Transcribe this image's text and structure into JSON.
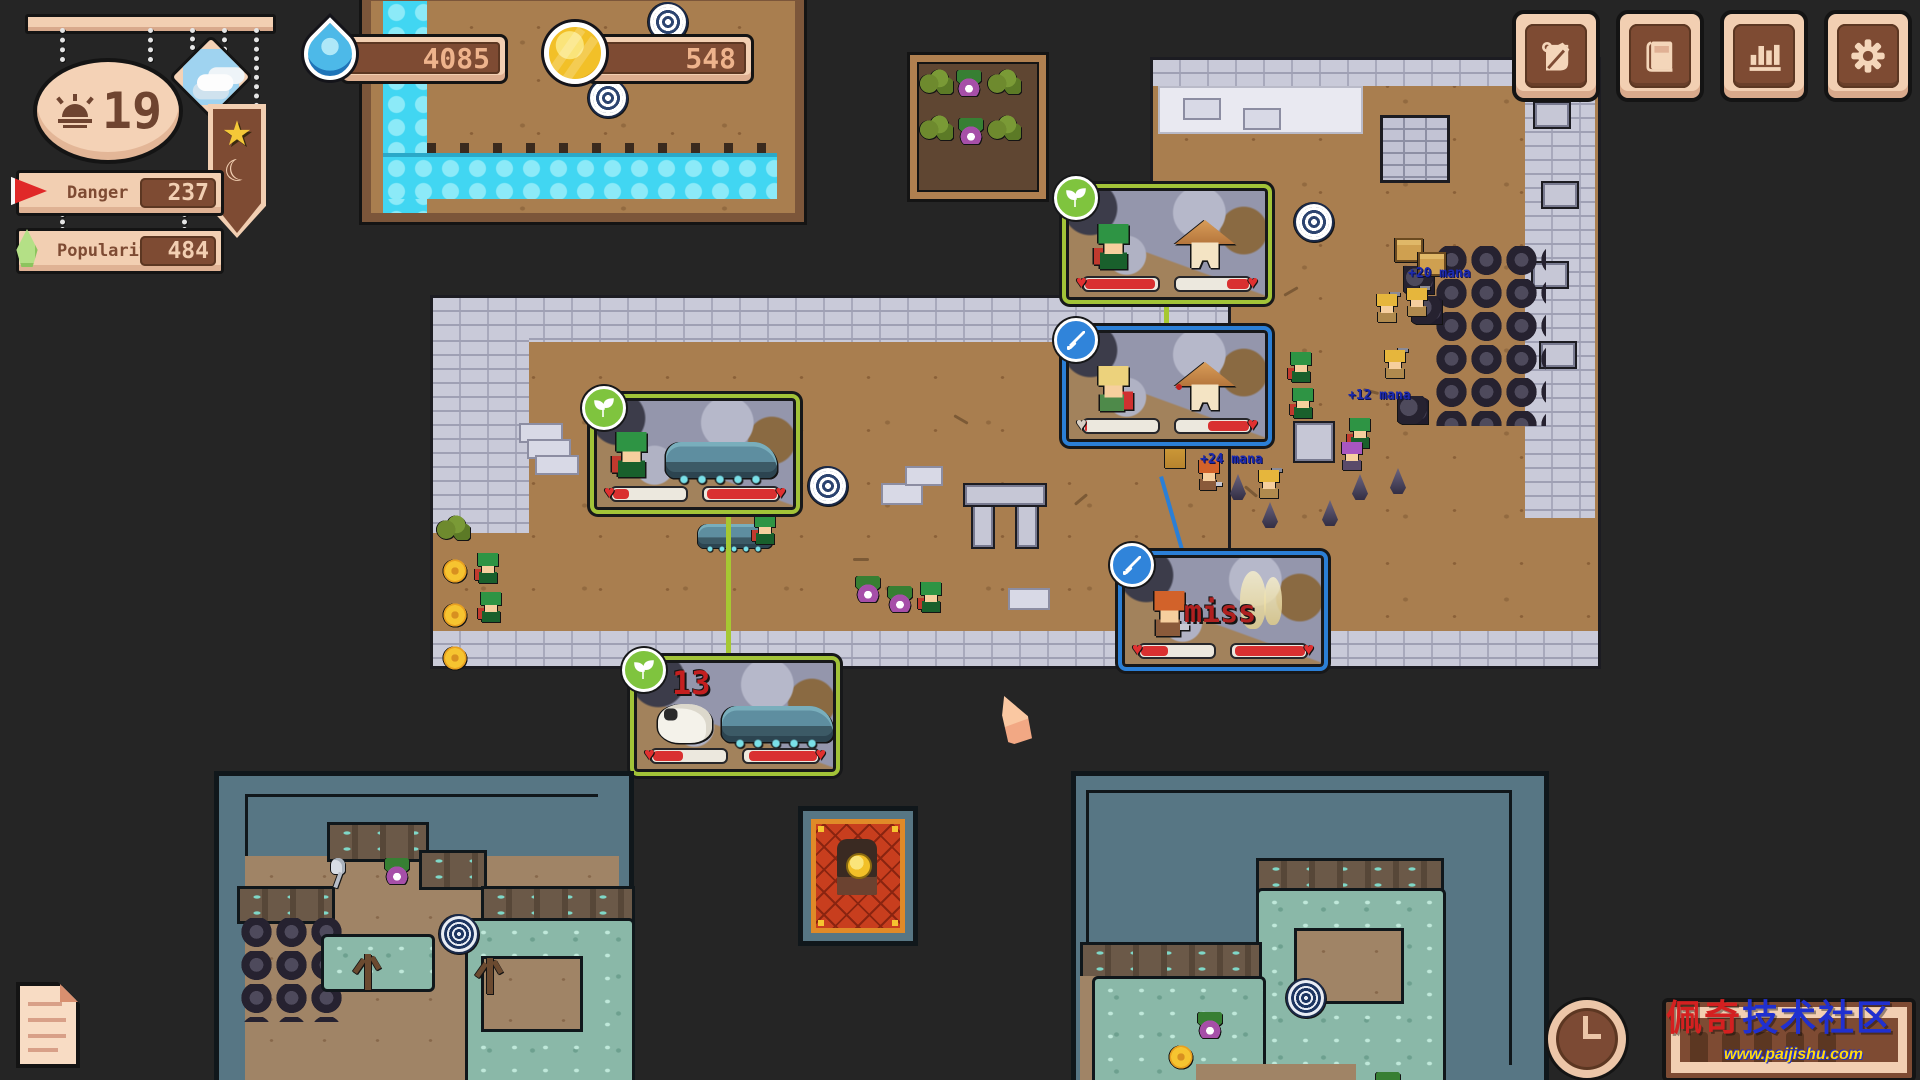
{
  "hud": {
    "day": "19",
    "day_icon": "sunrise",
    "weather_icon": "cloudy-sky",
    "banner_icons": [
      "gold-star",
      "crescent-moon"
    ],
    "danger": {
      "label": "Danger",
      "value": "237",
      "icon": "red-flag"
    },
    "popularity": {
      "label": "Popularity",
      "value": "484",
      "icon": "green-sprout"
    },
    "resources": {
      "water": {
        "value": "4085",
        "icon": "water-drop"
      },
      "gold": {
        "value": "548",
        "icon": "gold-coin"
      }
    }
  },
  "toolbar": {
    "buttons": [
      {
        "icon": "scroll-quill"
      },
      {
        "icon": "book"
      },
      {
        "icon": "bar-chart"
      },
      {
        "icon": "gear"
      }
    ]
  },
  "battles": [
    {
      "badge": "nature",
      "left_hp": 100,
      "right_hp": 30
    },
    {
      "badge": "combat",
      "left_hp": 3,
      "right_hp": 55
    },
    {
      "badge": "nature",
      "left_hp": 22,
      "right_hp": 100
    },
    {
      "badge": "nature",
      "left_hp": 40,
      "right_hp": 92,
      "damage": "13"
    },
    {
      "badge": "combat",
      "left_hp": 36,
      "right_hp": 95,
      "result": "miss"
    }
  ],
  "floating_texts": [
    {
      "text": "+20 mana"
    },
    {
      "text": "+12 mana"
    },
    {
      "text": "+24 mana"
    }
  ],
  "footer": {
    "watermark": {
      "title_red": "佩奇",
      "title_blue": "技术社区",
      "url": "www.paijishu.com"
    }
  },
  "colors": {
    "ui_cream": "#f2cfb2",
    "ui_brown": "#7e4b33",
    "accent_lime": "#a2c338",
    "accent_blue": "#2b7fd6",
    "hp_red": "#d93030",
    "water_cyan": "#41d6f2",
    "coin_gold": "#f2c028",
    "mana_text": "#1c2ab0"
  }
}
